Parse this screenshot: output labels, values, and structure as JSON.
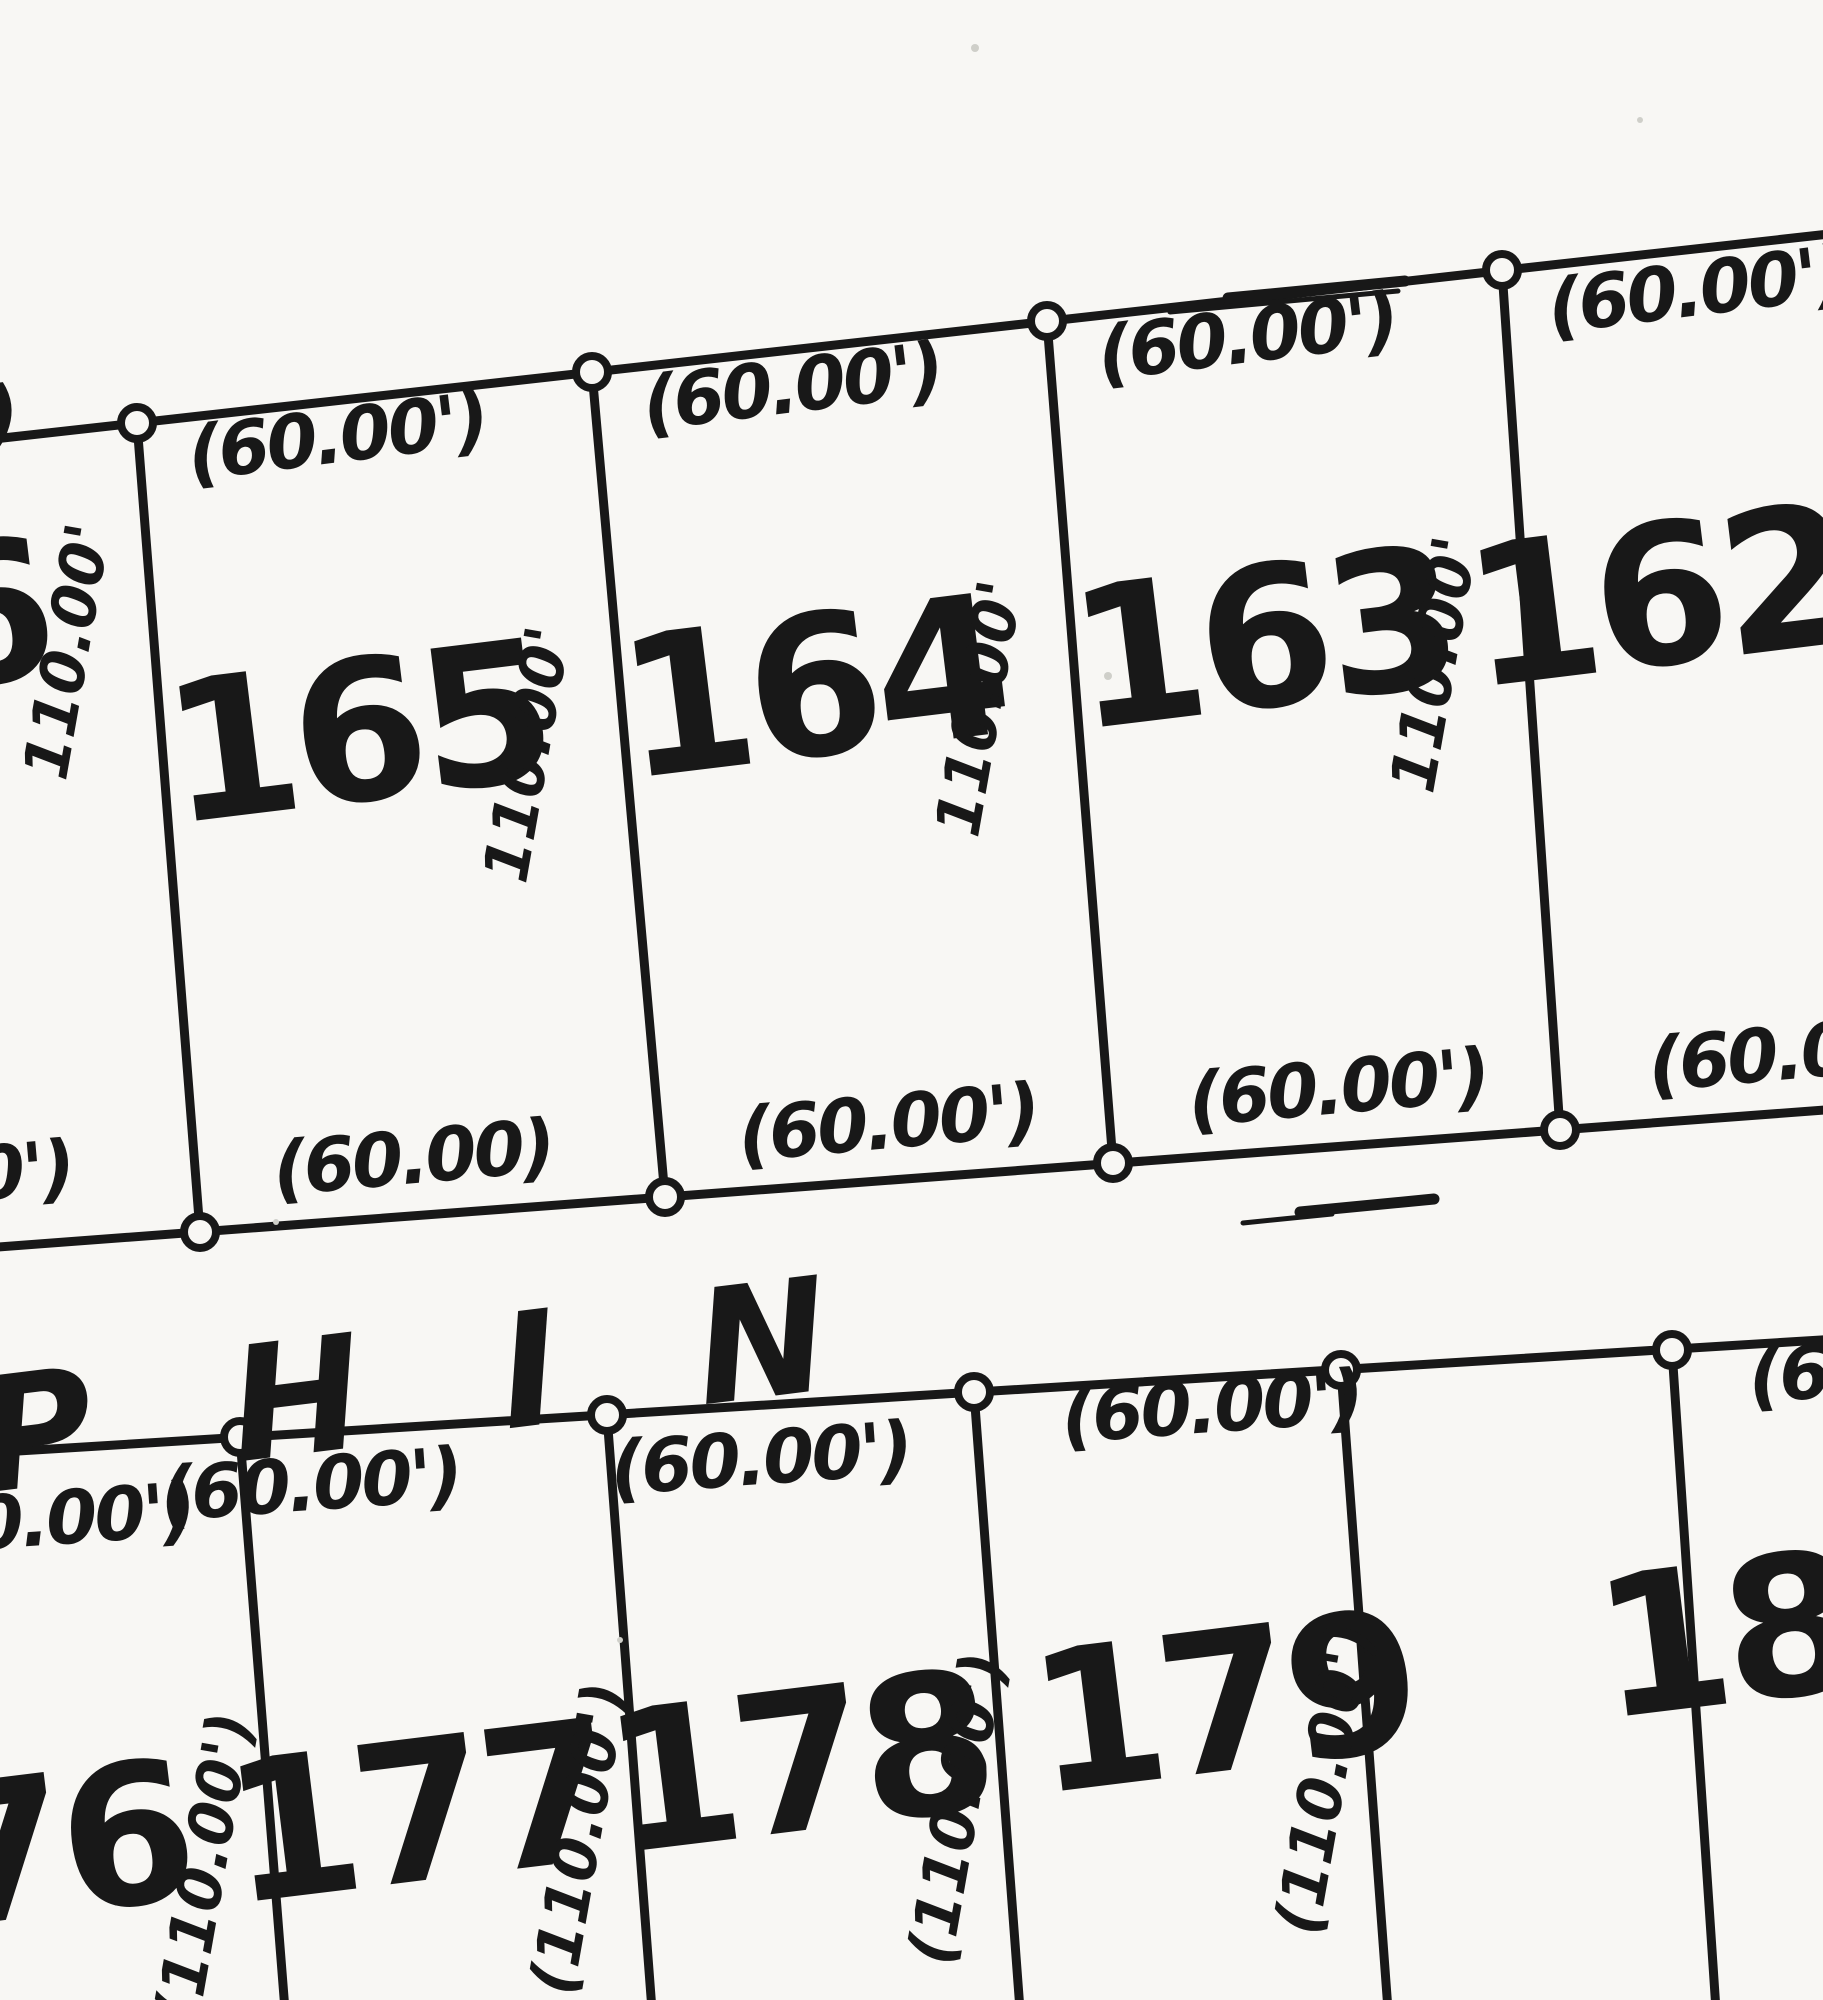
{
  "map": {
    "type": "plat-survey-map",
    "ink_color": "#181818",
    "paper_color": "#f8f7f4",
    "street": {
      "name": "P H I N"
    },
    "top_block": {
      "lots": [
        {
          "number": "166",
          "top_frontage": "(60.00')",
          "bottom_frontage": "(60.00')",
          "side_depth": "110.00'"
        },
        {
          "number": "165",
          "top_frontage": "(60.00')",
          "bottom_frontage": "(60.00)",
          "side_depth": "110.00'"
        },
        {
          "number": "164",
          "top_frontage": "(60.00')",
          "bottom_frontage": "(60.00')",
          "side_depth": "110.00'"
        },
        {
          "number": "163",
          "top_frontage": "(60.00')",
          "bottom_frontage": "(60.00')",
          "side_depth": "110.00'"
        },
        {
          "number": "162",
          "top_frontage": "(60.00')",
          "bottom_frontage": "(60.00')"
        }
      ]
    },
    "bottom_block": {
      "lots": [
        {
          "number": "176",
          "top_frontage": "(60.00')"
        },
        {
          "number": "177",
          "top_frontage": "(60.00')",
          "side_depth": "(110.00')"
        },
        {
          "number": "178",
          "top_frontage": "(60.00')",
          "side_depth": "(110.00')"
        },
        {
          "number": "179",
          "top_frontage": "(60.00')",
          "side_depth": "(110.00')"
        },
        {
          "number": "180",
          "top_frontage": "(60.00')",
          "side_depth": "(110.00')"
        }
      ]
    }
  }
}
